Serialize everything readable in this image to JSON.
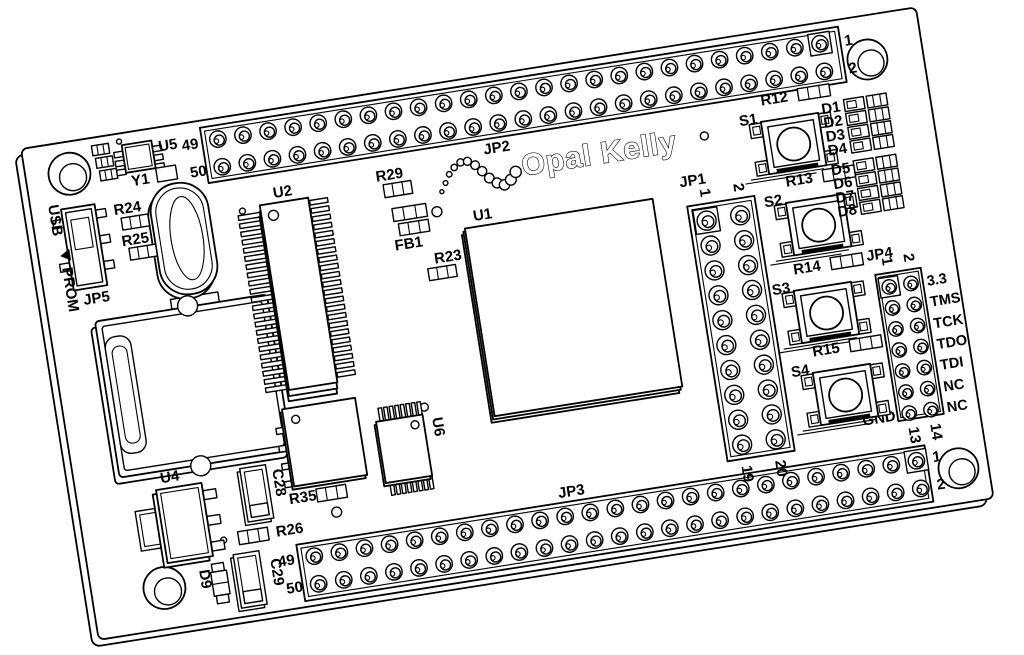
{
  "colors": {
    "ink": "#000000",
    "paper": "#ffffff"
  },
  "board": {
    "logo_text": "Opal Kelly",
    "ics": {
      "u1": "U1",
      "u2": "U2",
      "u4": "U4",
      "u5": "U5",
      "u6": "U6"
    },
    "crystal": "Y1",
    "switch": {
      "label": "JP5",
      "pos_top": "USB",
      "pos_bottom": "PROM"
    },
    "headers": {
      "jp2": {
        "title": "JP2",
        "left_top": "49",
        "left_bottom": "50",
        "right_top": "1",
        "right_bottom": "2"
      },
      "jp3": {
        "title": "JP3",
        "left_top": "49",
        "left_bottom": "50",
        "right_top": "1",
        "right_bottom": "2"
      },
      "jp1": {
        "title": "JP1",
        "top_col1": "1",
        "top_col2": "2",
        "bottom_col1": "19",
        "bottom_col2": "20"
      },
      "jp4": {
        "title": "JP4",
        "top_col1": "1",
        "top_col2": "2",
        "bottom_col1": "13",
        "bottom_col2": "14",
        "gnd": "GND",
        "pin_labels": [
          "3.3",
          "TMS",
          "TCK",
          "TDO",
          "TDI",
          "NC",
          "NC"
        ]
      }
    },
    "buttons": [
      {
        "switch": "S1",
        "resistor": "R12"
      },
      {
        "switch": "S2",
        "resistor": "R13"
      },
      {
        "switch": "S3",
        "resistor": "R14"
      },
      {
        "switch": "S4",
        "resistor": "R15"
      }
    ],
    "leds": [
      "D1",
      "D2",
      "D3",
      "D4",
      "D5",
      "D6",
      "D7",
      "D8"
    ],
    "led9": "D9",
    "resistors": {
      "r23": "R23",
      "r24": "R24",
      "r25": "R25",
      "r26": "R26",
      "r29": "R29",
      "r35": "R35"
    },
    "ferrite": "FB1",
    "caps": {
      "c28": "C28",
      "c29": "C29"
    }
  }
}
